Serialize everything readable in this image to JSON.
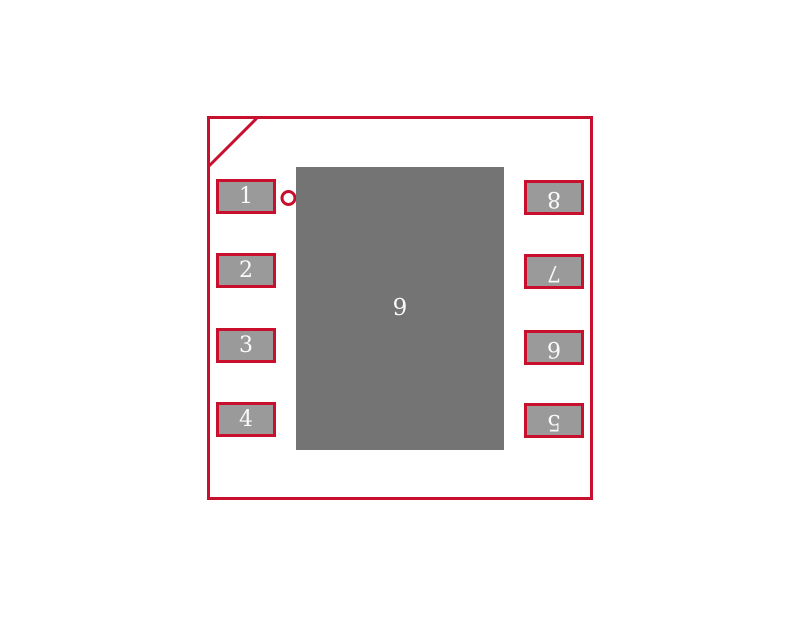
{
  "colors": {
    "outline": "#C8102E",
    "pad_border": "#C8102E",
    "pad_fill": "#9A9A9A",
    "thermal_pad_fill": "#747474",
    "pad_number": "#FAFAFA",
    "background": "#FFFFFF"
  },
  "pads": {
    "left_column": [
      {
        "number": "1"
      },
      {
        "number": "2"
      },
      {
        "number": "3"
      },
      {
        "number": "4"
      }
    ],
    "right_column": [
      {
        "number": "8"
      },
      {
        "number": "7"
      },
      {
        "number": "6"
      },
      {
        "number": "5"
      }
    ],
    "thermal": {
      "number": "9"
    }
  },
  "markers": {
    "pin1_indicator": "circle-icon",
    "corner_chamfer": "diagonal-line"
  }
}
